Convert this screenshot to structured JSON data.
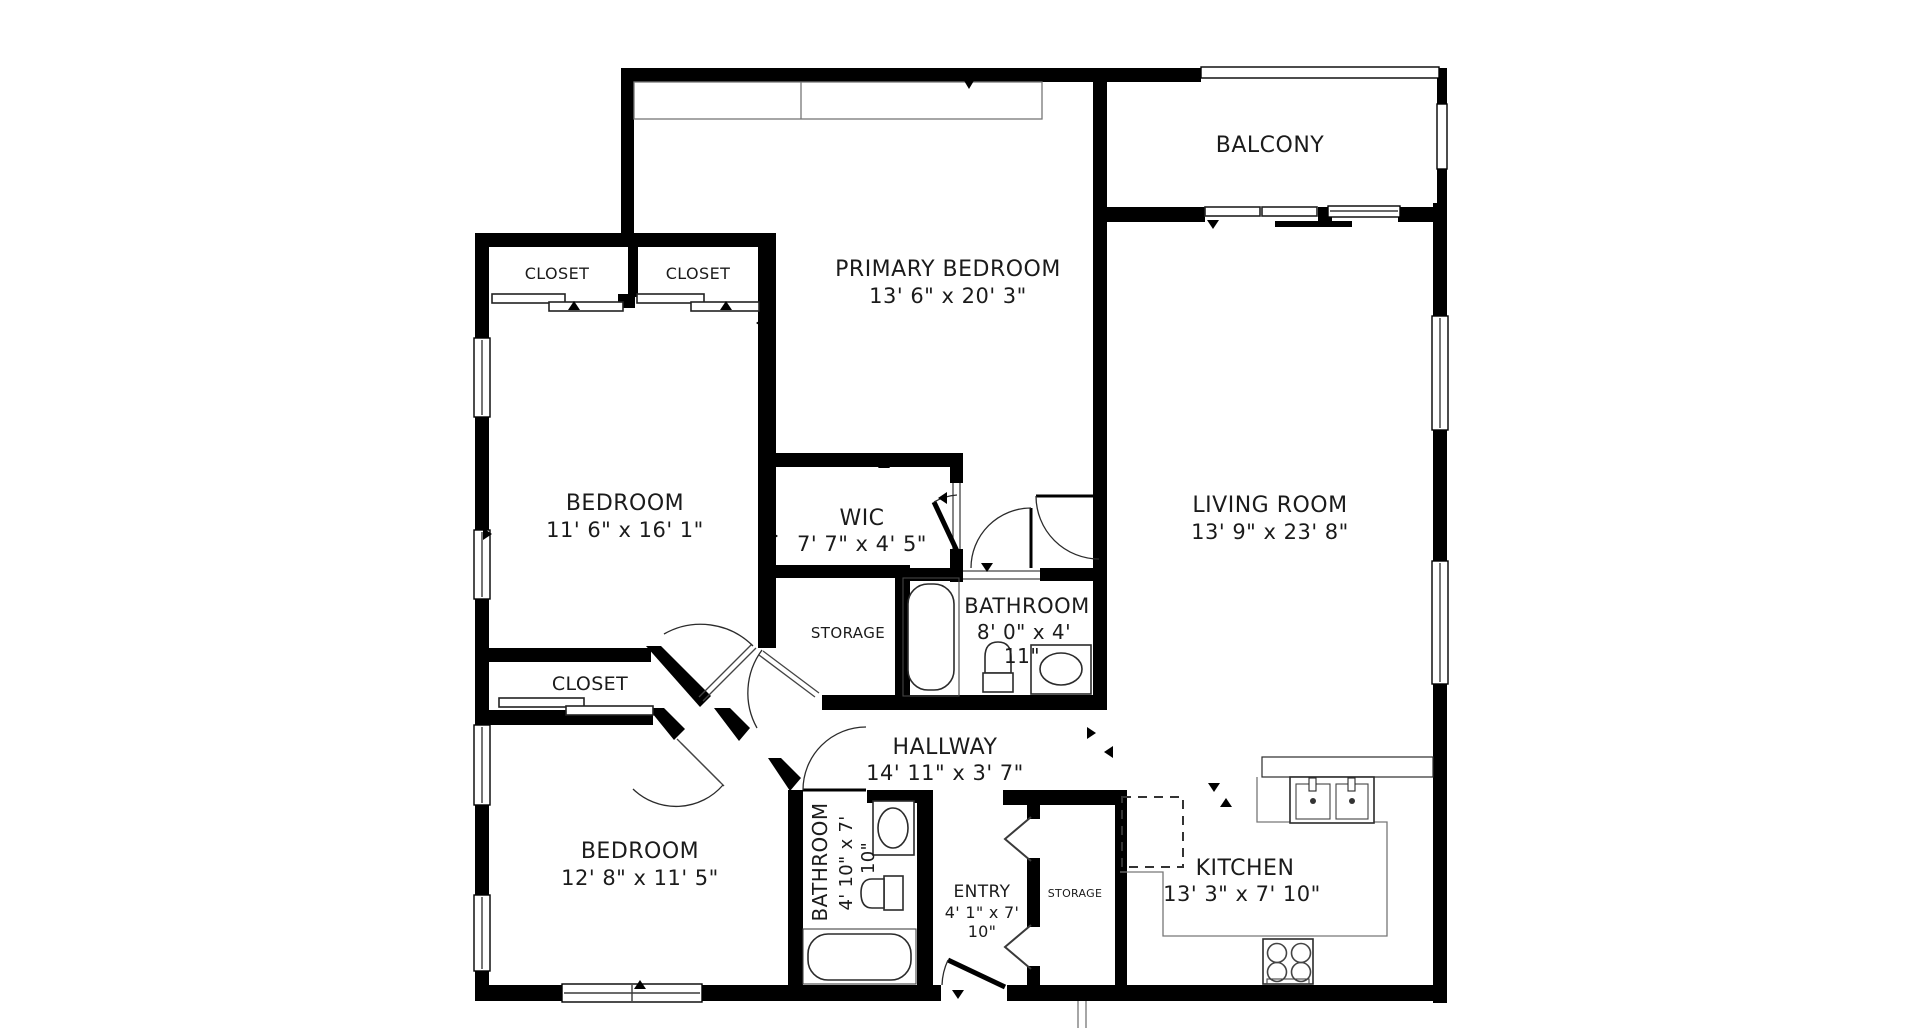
{
  "rooms": {
    "primary_bedroom": {
      "name": "PRIMARY BEDROOM",
      "dims": "13' 6\" x 20' 3\""
    },
    "balcony": {
      "name": "BALCONY"
    },
    "living_room": {
      "name": "LIVING ROOM",
      "dims": "13' 9\" x 23' 8\""
    },
    "bedroom_upper": {
      "name": "BEDROOM",
      "dims": "11' 6\" x 16' 1\""
    },
    "bedroom_lower": {
      "name": "BEDROOM",
      "dims": "12' 8\" x 11' 5\""
    },
    "wic": {
      "name": "WIC",
      "dims": "7' 7\" x 4' 5\""
    },
    "primary_bathroom": {
      "name": "BATHROOM",
      "dims_line1": "8' 0\" x 4'",
      "dims_line2": "11\""
    },
    "hall_bathroom": {
      "name": "BATHROOM",
      "dims_line1": "4' 10\" x 7'",
      "dims_line2": "10\""
    },
    "hallway": {
      "name": "HALLWAY",
      "dims": "14' 11\" x 3' 7\""
    },
    "entry": {
      "name": "ENTRY",
      "dims_line1": "4' 1\" x 7'",
      "dims_line2": "10\""
    },
    "kitchen": {
      "name": "KITCHEN",
      "dims": "13' 3\" x 7' 10\""
    },
    "storage_hall": {
      "name": "STORAGE"
    },
    "storage_entry": {
      "name": "STORAGE"
    },
    "closet_primary_left": {
      "name": "CLOSET"
    },
    "closet_primary_right": {
      "name": "CLOSET"
    },
    "closet_bedroom": {
      "name": "CLOSET"
    }
  },
  "colors": {
    "wall": "#000000",
    "background": "#ffffff",
    "text": "#1b1b1b"
  }
}
